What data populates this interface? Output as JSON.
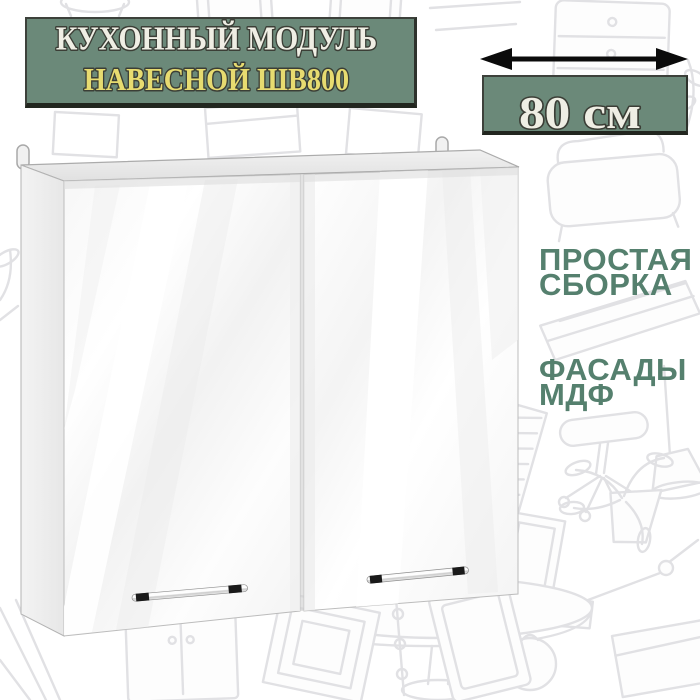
{
  "card": {
    "background_color": "#ffffff",
    "doodle_color": "#e1e1e4"
  },
  "title_plate": {
    "line1": "КУХОННЫЙ МОДУЛЬ",
    "line2": "НАВЕСНОЙ ШВ800",
    "plate_color": "#6b8979",
    "line1_color": "#efeee4",
    "line2_color": "#e7db70",
    "outline_color": "#3b3e36"
  },
  "dimension": {
    "label": "80 см",
    "plate_color": "#6b8979",
    "label_color": "#efeee4",
    "arrow_color": "#0b0b0b",
    "arrow_icon": "double-headed-horizontal-arrow"
  },
  "features": [
    {
      "line1": "ПРОСТАЯ",
      "line2": "СБОРКА"
    },
    {
      "line1": "ФАСАДЫ",
      "line2": "МДФ"
    }
  ],
  "features_text_color": "#55806e",
  "product": {
    "kind": "wall-mounted kitchen cabinet with two glossy white doors",
    "door_color": "#ffffff",
    "carcass_color": "#ececec",
    "handle_style": "horizontal chrome rail with dark end caps",
    "handle_count": 2,
    "hanging_loop_count": 2
  }
}
